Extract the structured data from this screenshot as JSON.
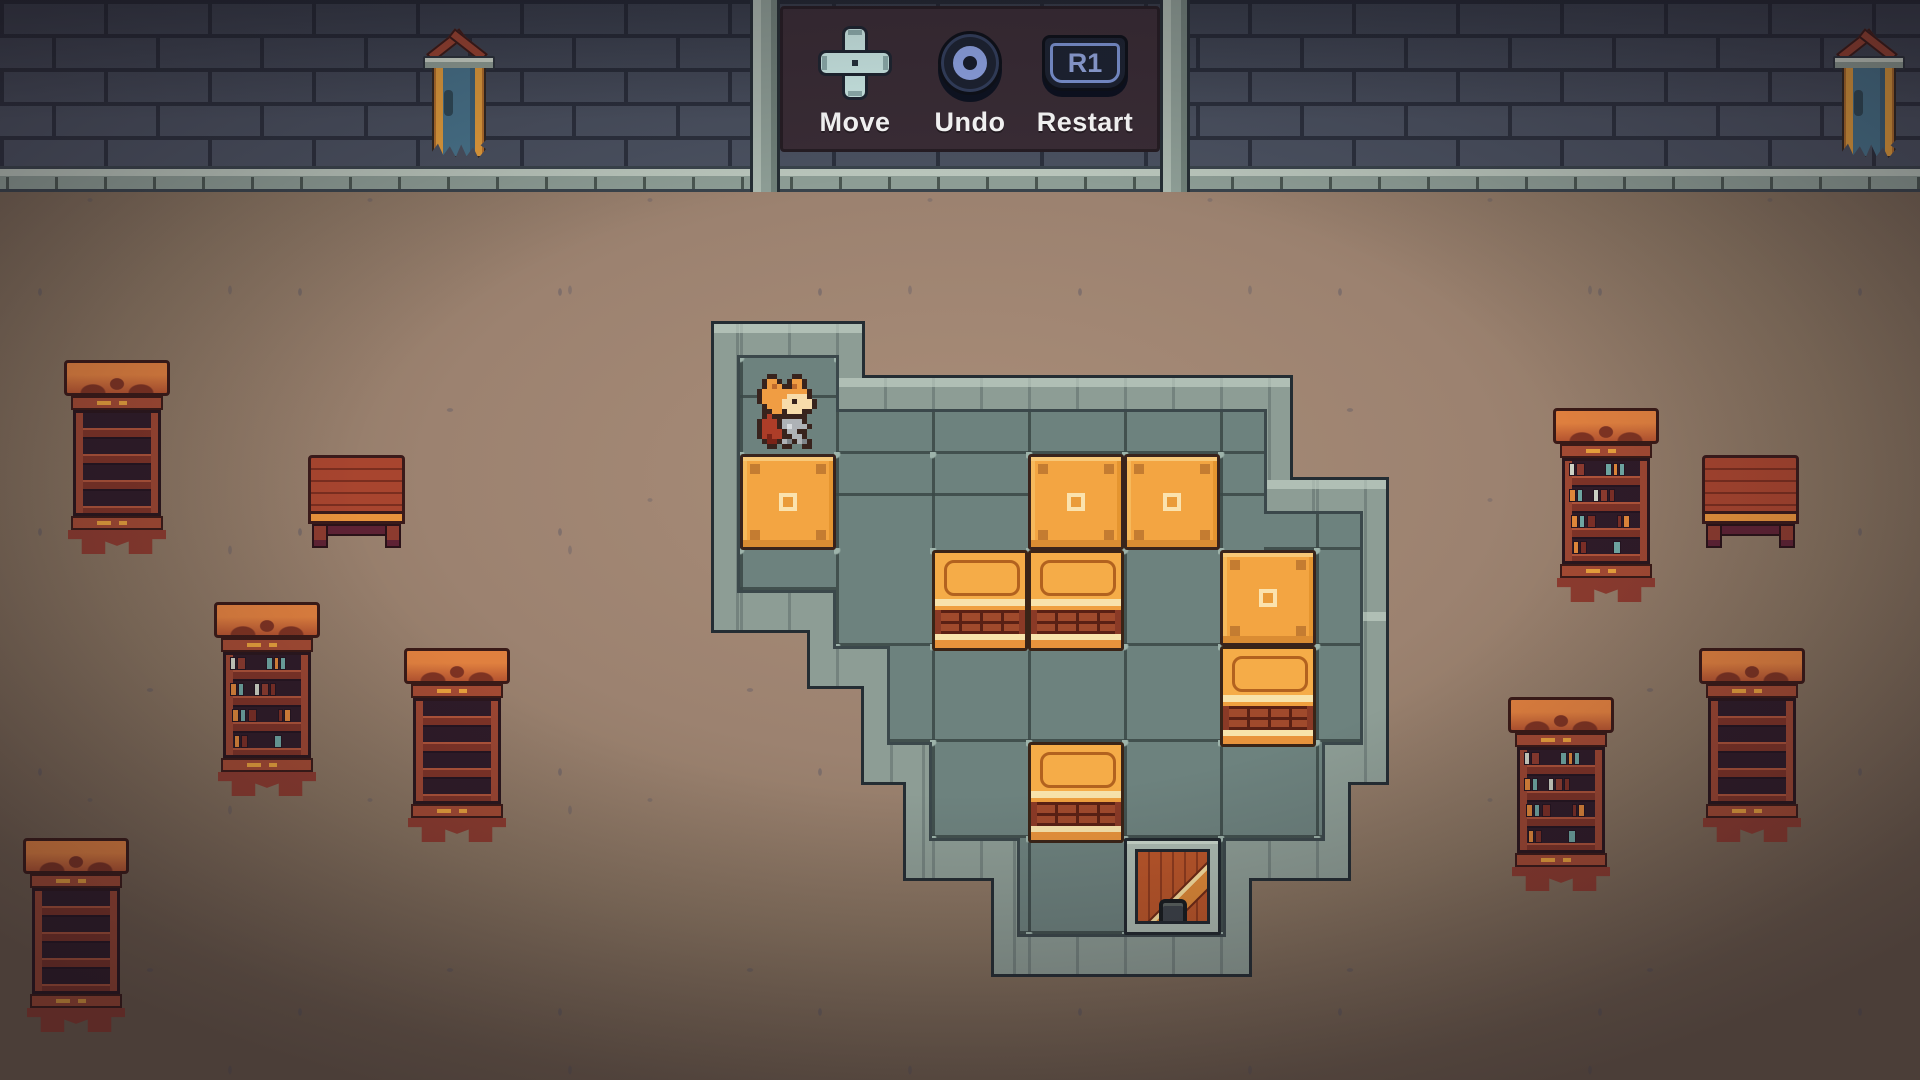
{
  "hud": {
    "controls": [
      {
        "id": "move",
        "label": "Move",
        "icon": "dpad-icon"
      },
      {
        "id": "undo",
        "label": "Undo",
        "icon": "circle-button-icon"
      },
      {
        "id": "restart",
        "label": "Restart",
        "icon": "r1-button-icon",
        "key_text": "R1"
      }
    ]
  },
  "puzzle": {
    "origin": {
      "x": 740,
      "y": 358
    },
    "tile_size": 96,
    "floor_rects": [
      {
        "x": 0,
        "y": 0,
        "w": 96,
        "h": 232
      },
      {
        "x": 96,
        "y": 54,
        "w": 428,
        "h": 138
      },
      {
        "x": 96,
        "y": 192,
        "w": 524,
        "h": 96
      },
      {
        "x": 150,
        "y": 288,
        "w": 470,
        "h": 96
      },
      {
        "x": 192,
        "y": 384,
        "w": 390,
        "h": 96
      },
      {
        "x": 280,
        "y": 480,
        "w": 203,
        "h": 96
      },
      {
        "x": 524,
        "y": 156,
        "w": 96,
        "h": 36
      }
    ],
    "player": {
      "type": "fox-hero",
      "col": 0,
      "row": 0,
      "facing": "right"
    },
    "blocks": [
      {
        "type": "crate",
        "col": 0,
        "row": 1
      },
      {
        "type": "crate",
        "col": 3,
        "row": 1
      },
      {
        "type": "crate",
        "col": 4,
        "row": 1
      },
      {
        "type": "crate",
        "col": 5,
        "row": 2
      },
      {
        "type": "cabinet",
        "col": 2,
        "row": 2
      },
      {
        "type": "cabinet",
        "col": 3,
        "row": 2
      },
      {
        "type": "cabinet",
        "col": 5,
        "row": 3
      },
      {
        "type": "cabinet",
        "col": 3,
        "row": 4
      }
    ],
    "goal": {
      "type": "trapdoor",
      "col": 4,
      "row": 5
    }
  },
  "room": {
    "banners": [
      {
        "x": 423,
        "y": 28
      },
      {
        "x": 1833,
        "y": 28
      }
    ],
    "furniture": [
      {
        "type": "bookshelf",
        "x": 68,
        "y": 360,
        "books": false
      },
      {
        "type": "table",
        "x": 308,
        "y": 455
      },
      {
        "type": "bookshelf",
        "x": 218,
        "y": 602,
        "books": true
      },
      {
        "type": "bookshelf",
        "x": 408,
        "y": 648,
        "books": false
      },
      {
        "type": "bookshelf",
        "x": 27,
        "y": 838,
        "books": false
      },
      {
        "type": "bookshelf",
        "x": 1557,
        "y": 408,
        "books": true
      },
      {
        "type": "table",
        "x": 1702,
        "y": 455
      },
      {
        "type": "bookshelf",
        "x": 1512,
        "y": 697,
        "books": true
      },
      {
        "type": "bookshelf",
        "x": 1703,
        "y": 648,
        "books": false
      }
    ],
    "book_colors": [
      "#cfd3c6",
      "#7c2f26",
      "#6fa8a4",
      "#e0873a",
      "#8c3b2f",
      "#46606c"
    ],
    "book_rows": [
      [
        {
          "x": 4,
          "w": 6,
          "c": 0
        },
        {
          "x": 11,
          "w": 9,
          "c": 4
        },
        {
          "x": 40,
          "w": 7,
          "c": 2
        },
        {
          "x": 48,
          "w": 5,
          "c": 3
        },
        {
          "x": 54,
          "w": 6,
          "c": 2
        }
      ],
      [
        {
          "x": 4,
          "w": 7,
          "c": 3
        },
        {
          "x": 12,
          "w": 6,
          "c": 2
        },
        {
          "x": 28,
          "w": 6,
          "c": 0
        },
        {
          "x": 35,
          "w": 8,
          "c": 4
        },
        {
          "x": 44,
          "w": 6,
          "c": 1
        }
      ],
      [
        {
          "x": 6,
          "w": 7,
          "c": 3
        },
        {
          "x": 14,
          "w": 6,
          "c": 2
        },
        {
          "x": 22,
          "w": 9,
          "c": 1
        },
        {
          "x": 52,
          "w": 5,
          "c": 1
        },
        {
          "x": 58,
          "w": 7,
          "c": 3
        }
      ],
      [
        {
          "x": 8,
          "w": 6,
          "c": 3
        },
        {
          "x": 15,
          "w": 7,
          "c": 1
        },
        {
          "x": 48,
          "w": 8,
          "c": 2
        }
      ]
    ]
  },
  "colors": {
    "wall_brick": "#4a5160",
    "wall_mortar": "#2b303d",
    "ledge_stone": "#8d9d95",
    "floor_brown": "#9c8270",
    "hud_panel": "#392c35",
    "hud_text": "#ffffff",
    "button_blue": "#8fa5e6",
    "dpad_cyan": "#cfeeea",
    "tile_green": "#6d827e",
    "rim_stone": "#8d9d95",
    "crate_orange": "#f3a542",
    "wood_red": "#a8452f",
    "banner_teal": "#48758d",
    "banner_gold": "#e8a13c",
    "cape_red": "#ad3d28"
  }
}
